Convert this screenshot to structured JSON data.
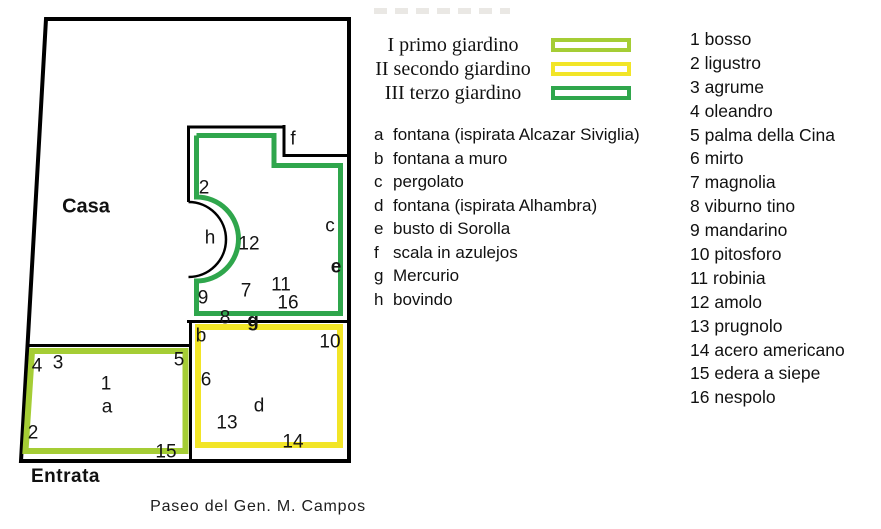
{
  "map": {
    "casa_label": "Casa",
    "entrata_label": "Entrata",
    "street_label": "Paseo del Gen. M. Campos",
    "colors": {
      "primo": "#a5cd35",
      "secondo": "#f2e527",
      "terzo": "#2fa64c",
      "outline": "#000000"
    },
    "labels": [
      {
        "text": "f"
      },
      {
        "text": "2"
      },
      {
        "text": "h"
      },
      {
        "text": "12"
      },
      {
        "text": "c"
      },
      {
        "text": "e"
      },
      {
        "text": "9"
      },
      {
        "text": "7"
      },
      {
        "text": "11"
      },
      {
        "text": "16"
      },
      {
        "text": "8"
      },
      {
        "text": "g"
      },
      {
        "text": "b"
      },
      {
        "text": "10"
      },
      {
        "text": "6"
      },
      {
        "text": "d"
      },
      {
        "text": "13"
      },
      {
        "text": "14"
      },
      {
        "text": "4"
      },
      {
        "text": "3"
      },
      {
        "text": "5"
      },
      {
        "text": "1"
      },
      {
        "text": "a"
      },
      {
        "text": "2"
      },
      {
        "text": "15"
      }
    ]
  },
  "legend_gardens": {
    "items": [
      {
        "label": "I primo giardino",
        "color": "#a5cd35"
      },
      {
        "label": "II secondo giardino",
        "color": "#f2e527"
      },
      {
        "label": "III terzo giardino",
        "color": "#2fa64c"
      }
    ]
  },
  "legend_features": {
    "items": [
      {
        "key": "a",
        "label": "fontana (ispirata Alcazar Siviglia)"
      },
      {
        "key": "b",
        "label": "fontana a muro"
      },
      {
        "key": "c",
        "label": "pergolato"
      },
      {
        "key": "d",
        "label": "fontana (ispirata Alhambra)"
      },
      {
        "key": "e",
        "label": "busto di Sorolla"
      },
      {
        "key": "f",
        "label": "scala in azulejos"
      },
      {
        "key": "g",
        "label": "Mercurio"
      },
      {
        "key": "h",
        "label": "bovindo"
      }
    ]
  },
  "legend_plants": {
    "items": [
      {
        "num": "1",
        "label": "bosso"
      },
      {
        "num": "2",
        "label": "ligustro"
      },
      {
        "num": "3",
        "label": "agrume"
      },
      {
        "num": "4",
        "label": "oleandro"
      },
      {
        "num": "5",
        "label": "palma della Cina"
      },
      {
        "num": "6",
        "label": "mirto"
      },
      {
        "num": "7",
        "label": "magnolia"
      },
      {
        "num": "8",
        "label": "viburno tino"
      },
      {
        "num": "9",
        "label": "mandarino"
      },
      {
        "num": "10",
        "label": "pitosforo"
      },
      {
        "num": "11",
        "label": "robinia"
      },
      {
        "num": "12",
        "label": "amolo"
      },
      {
        "num": "13",
        "label": "prugnolo"
      },
      {
        "num": "14",
        "label": "acero americano"
      },
      {
        "num": "15",
        "label": "edera a siepe"
      },
      {
        "num": "16",
        "label": "nespolo"
      }
    ]
  }
}
